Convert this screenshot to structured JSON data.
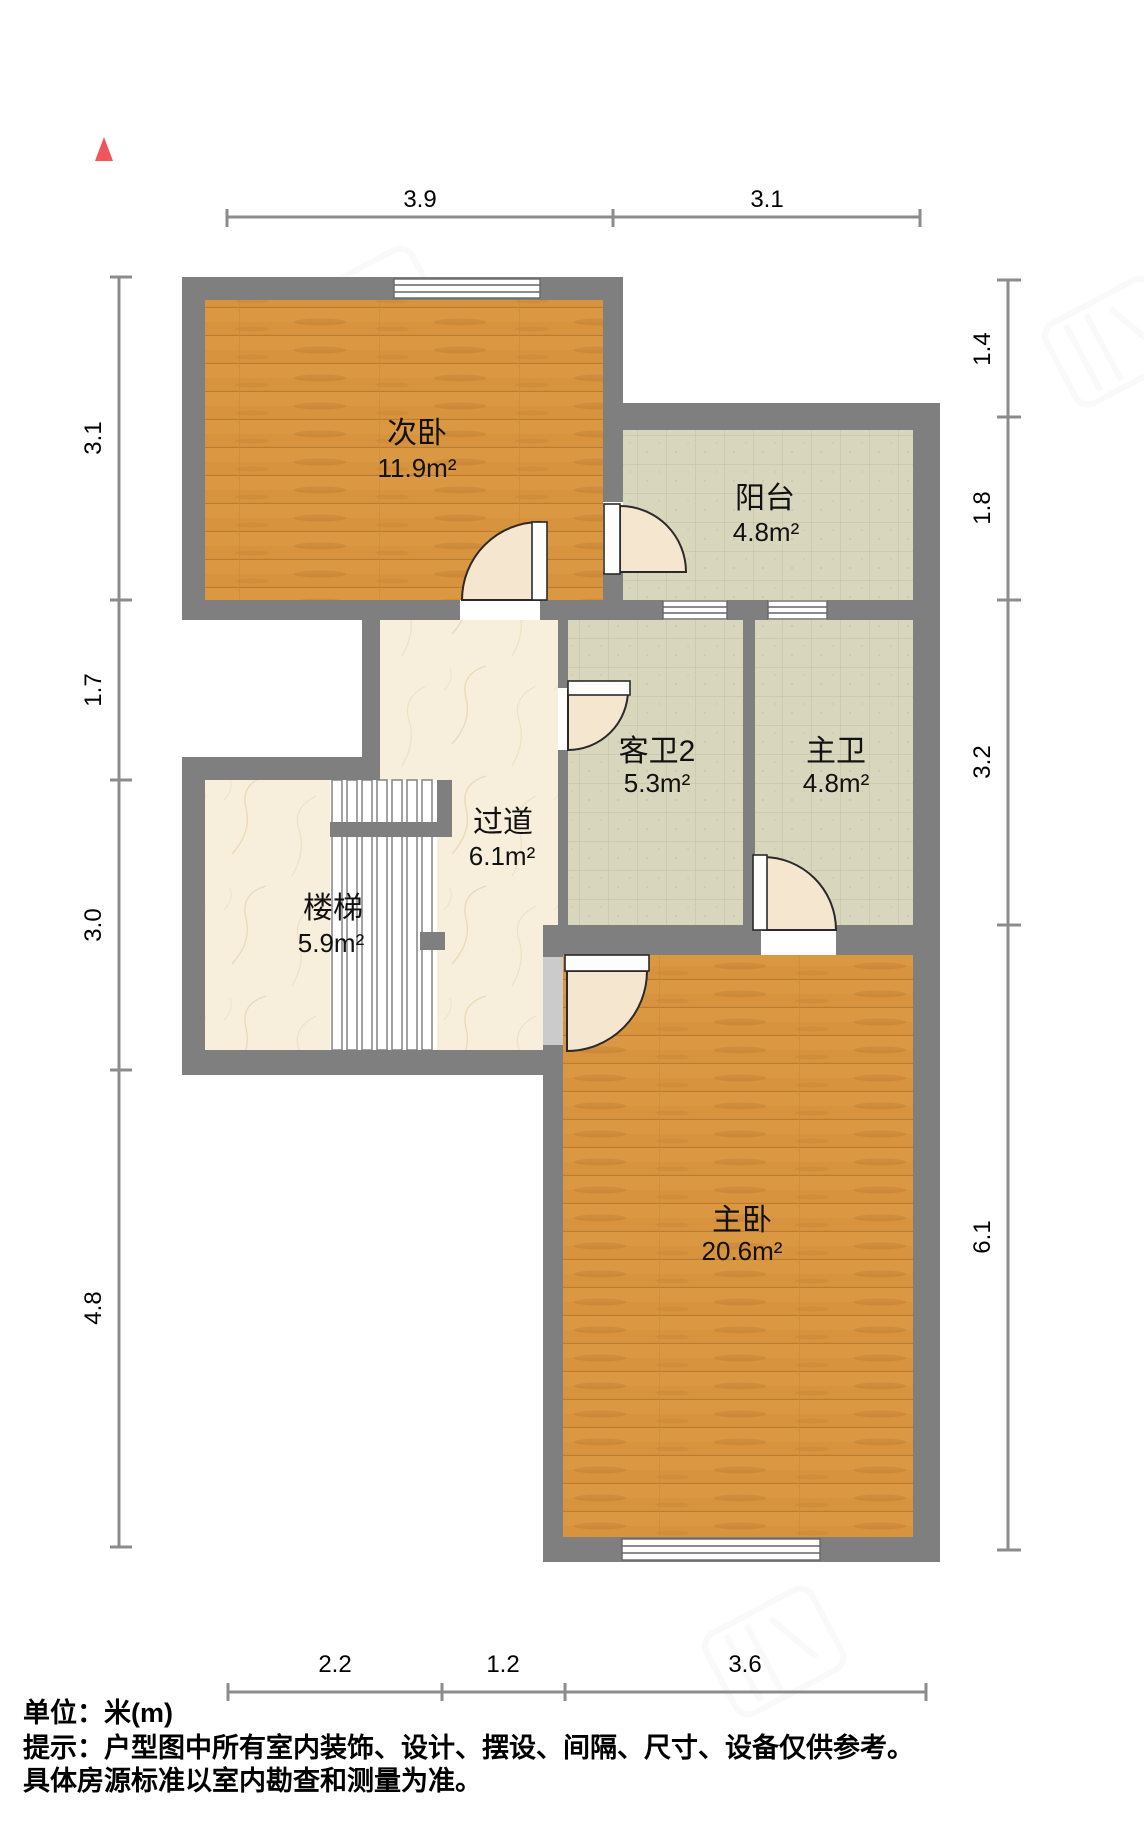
{
  "plan": {
    "title_hint": "residential floor plan (second floor)",
    "unit_note": "单位：米(m)",
    "disclaimer_line1": "提示：户型图中所有室内装饰、设计、摆设、间隔、尺寸、设备仅供参考。",
    "disclaimer_line2": "具体房源标准以室内勘查和测量为准。"
  },
  "rooms": [
    {
      "name": "次卧",
      "area": "11.9m²",
      "floor": "wood"
    },
    {
      "name": "阳台",
      "area": "4.8m²",
      "floor": "tile"
    },
    {
      "name": "客卫2",
      "area": "5.3m²",
      "floor": "tile"
    },
    {
      "name": "主卫",
      "area": "4.8m²",
      "floor": "tile"
    },
    {
      "name": "过道",
      "area": "6.1m²",
      "floor": "marble"
    },
    {
      "name": "楼梯",
      "area": "5.9m²",
      "floor": "marble"
    },
    {
      "name": "主卧",
      "area": "20.6m²",
      "floor": "wood"
    }
  ],
  "dimensions": {
    "top": [
      "3.9",
      "3.1"
    ],
    "left": [
      "3.1",
      "1.7",
      "3.0",
      "4.8"
    ],
    "right": [
      "1.4",
      "1.8",
      "3.2",
      "6.1"
    ],
    "bottom": [
      "2.2",
      "1.2",
      "3.6"
    ]
  },
  "icons": {
    "north_arrow": "north-arrow-red-triangle"
  },
  "colors": {
    "wall": "#7F7F7F",
    "wood_floor": "#D7933D",
    "tile_floor": "#D9D6BE",
    "marble_floor": "#F7EFDC",
    "door_sector": "#F5E6D0",
    "dimension_line": "#8C8C8C",
    "north_arrow": "#F0545C",
    "text": "#000000"
  }
}
